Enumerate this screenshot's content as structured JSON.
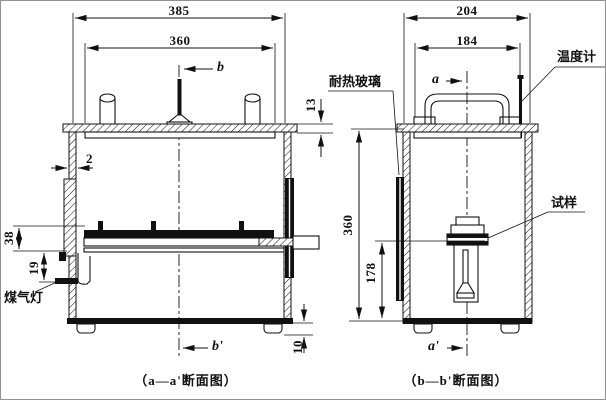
{
  "drawing": {
    "left_view": {
      "caption": "（a—a'断面图）",
      "dim_width_outer": "385",
      "dim_width_inner": "360",
      "dim_lid_height": "13",
      "dim_wall_thickness": "2",
      "dim_tray_height": "38",
      "dim_burner_height": "19",
      "dim_foot_height": "10",
      "mark_top": "b",
      "mark_bottom": "b'",
      "label_gas_burner": "煤气灯"
    },
    "right_view": {
      "caption": "（b—b'断面图）",
      "dim_width_outer": "204",
      "dim_width_inner": "184",
      "dim_inner_height": "360",
      "dim_specimen_height": "178",
      "mark_top": "a",
      "mark_bottom": "a'",
      "label_thermometer": "温度计",
      "label_heat_glass": "耐热玻璃",
      "label_specimen": "试样"
    }
  }
}
